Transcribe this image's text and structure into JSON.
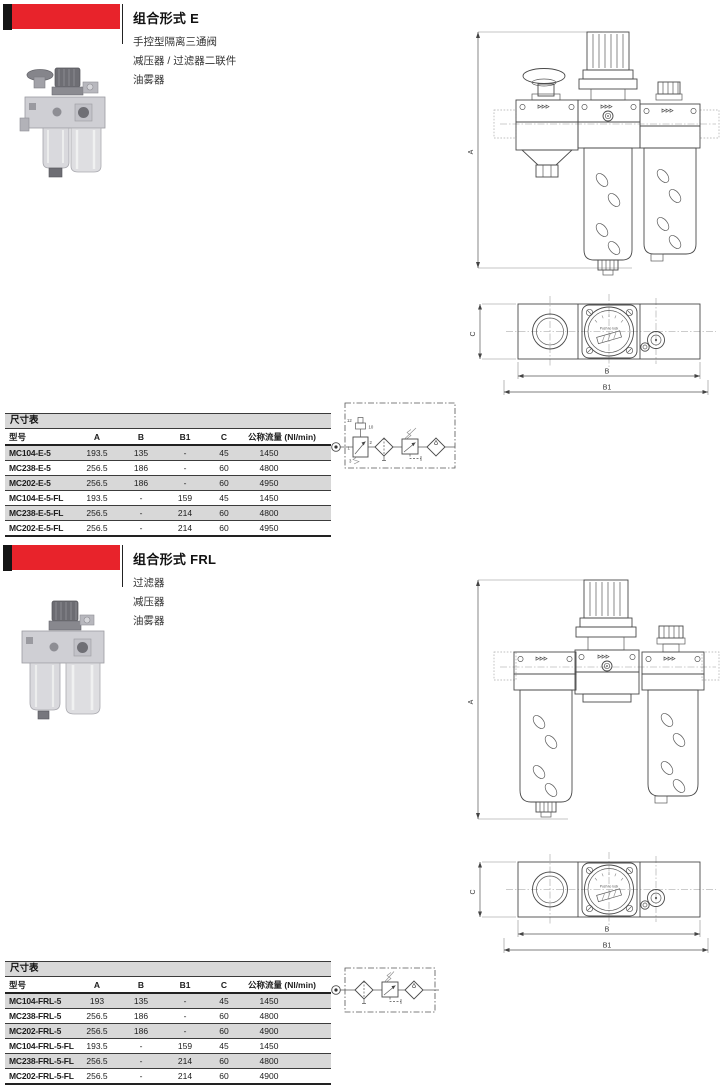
{
  "colors": {
    "accent_red": "#e8232b",
    "tab_black": "#151515",
    "row_gray": "#d8d8d8",
    "drawing_stroke": "#4a4a4a"
  },
  "sections": [
    {
      "id": "E",
      "title": "组合形式 E",
      "description_lines": [
        "手控型隔离三通阀",
        "减压器 / 过滤器二联件",
        "油雾器"
      ],
      "table": {
        "caption": "尺寸表",
        "columns": [
          "型号",
          "A",
          "B",
          "B1",
          "C",
          "公称流量 (Nl/min)"
        ],
        "rows": [
          [
            "MC104-E-5",
            "193.5",
            "135",
            "-",
            "45",
            "1450"
          ],
          [
            "MC238-E-5",
            "256.5",
            "186",
            "-",
            "60",
            "4800"
          ],
          [
            "MC202-E-5",
            "256.5",
            "186",
            "-",
            "60",
            "4950"
          ],
          [
            "MC104-E-5-FL",
            "193.5",
            "-",
            "159",
            "45",
            "1450"
          ],
          [
            "MC238-E-5-FL",
            "256.5",
            "-",
            "214",
            "60",
            "4800"
          ],
          [
            "MC202-E-5-FL",
            "256.5",
            "-",
            "214",
            "60",
            "4950"
          ]
        ]
      },
      "drawing": {
        "dim_a": "A",
        "dim_b": "B",
        "dim_b1": "B1",
        "dim_c": "C",
        "gauge_label": "Push to lock"
      },
      "circuit": {
        "port_12": "12",
        "port_10": "10",
        "port_1": "1",
        "port_2": "2",
        "port_3": "3"
      }
    },
    {
      "id": "FRL",
      "title": "组合形式 FRL",
      "description_lines": [
        "过滤器",
        "减压器",
        "油雾器"
      ],
      "table": {
        "caption": "尺寸表",
        "columns": [
          "型号",
          "A",
          "B",
          "B1",
          "C",
          "公称流量 (Nl/min)"
        ],
        "rows": [
          [
            "MC104-FRL-5",
            "193",
            "135",
            "-",
            "45",
            "1450"
          ],
          [
            "MC238-FRL-5",
            "256.5",
            "186",
            "-",
            "60",
            "4800"
          ],
          [
            "MC202-FRL-5",
            "256.5",
            "186",
            "-",
            "60",
            "4900"
          ],
          [
            "MC104-FRL-5-FL",
            "193.5",
            "-",
            "159",
            "45",
            "1450"
          ],
          [
            "MC238-FRL-5-FL",
            "256.5",
            "-",
            "214",
            "60",
            "4800"
          ],
          [
            "MC202-FRL-5-FL",
            "256.5",
            "-",
            "214",
            "60",
            "4900"
          ]
        ]
      },
      "drawing": {
        "dim_a": "A",
        "dim_b": "B",
        "dim_b1": "B1",
        "dim_c": "C",
        "gauge_label": "Push to lock"
      }
    }
  ]
}
